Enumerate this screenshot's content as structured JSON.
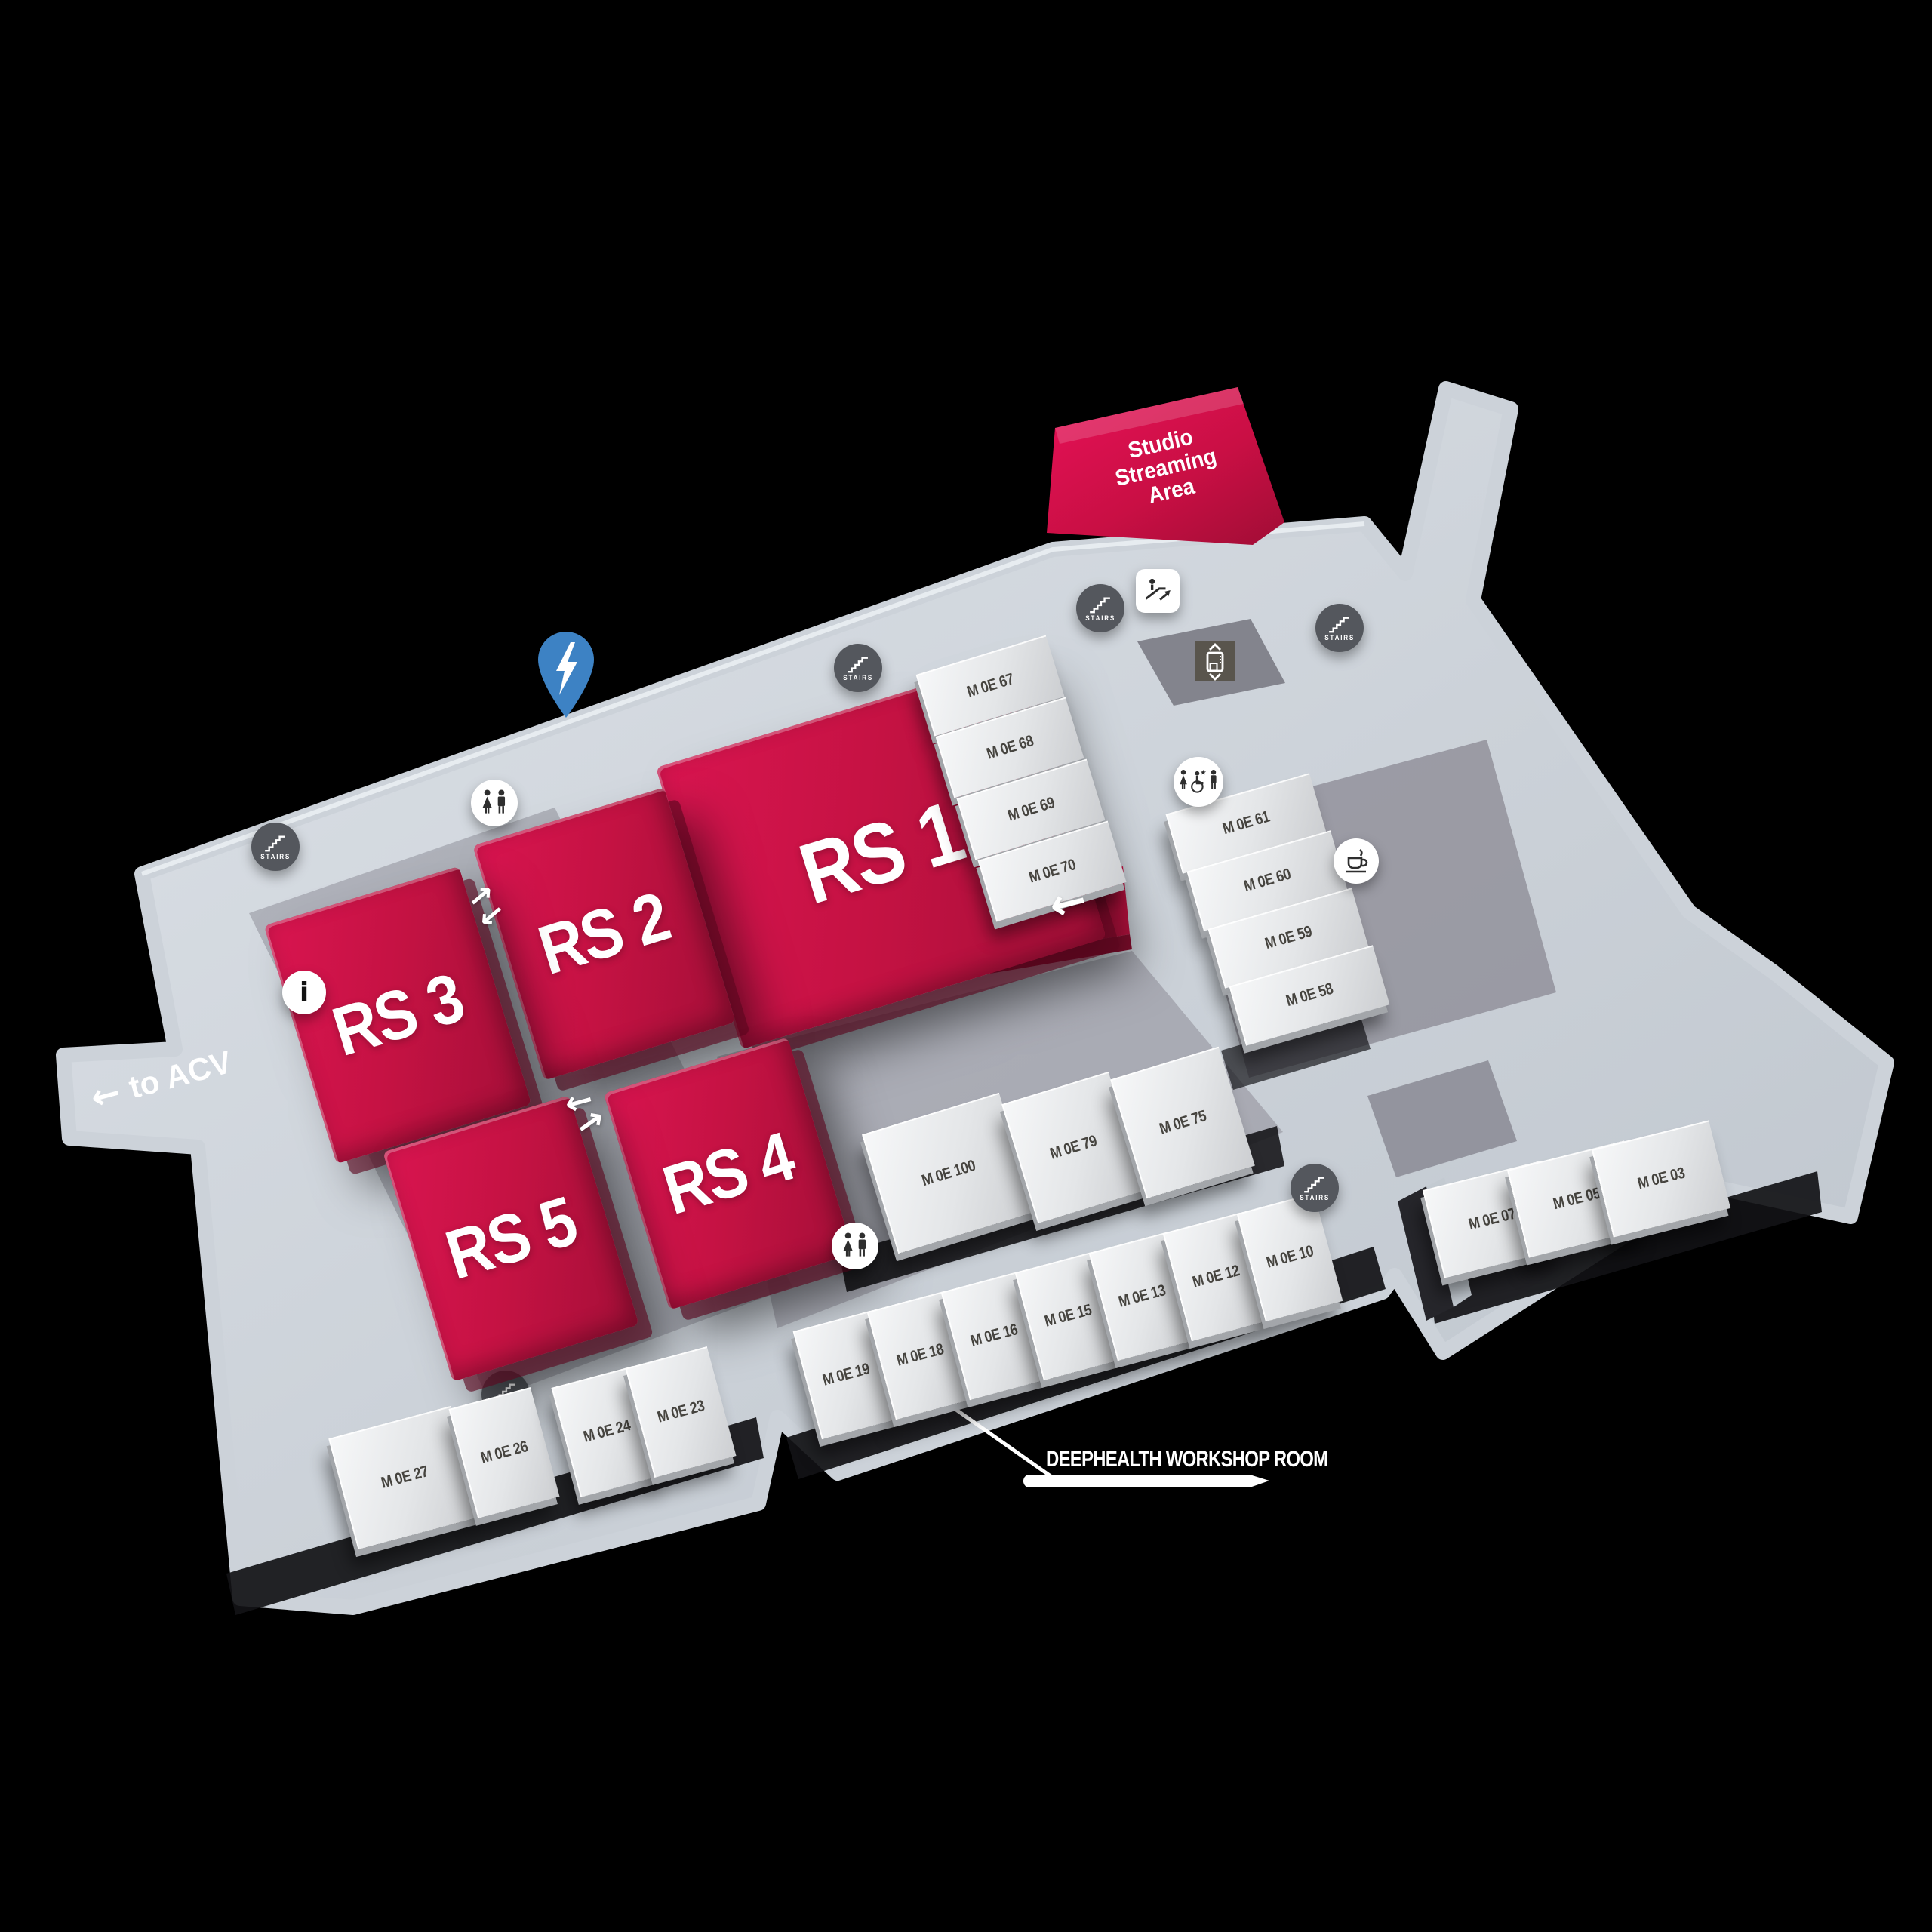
{
  "palette": {
    "background": "#000000",
    "floor": "#c9cfd6",
    "platform_dark": "#8e8d97",
    "red": "#c51243",
    "red_bright": "#e01155",
    "block_face": "#eceef0",
    "room_label": "#46443f",
    "stairs_circle": "#54575d",
    "pin_blue": "#3d82c4",
    "white": "#ffffff"
  },
  "labels": {
    "stairs": "STAIRS",
    "to_acv": "to ACV",
    "arrow_left": "←",
    "arrow_right": "→",
    "deephealth": "DEEPHEALTH WORKSHOP ROOM",
    "info_glyph": "i"
  },
  "studio": {
    "line1": "Studio",
    "line2": "Streaming",
    "line3": "Area"
  },
  "rs_blocks": [
    {
      "label": "RS 1"
    },
    {
      "label": "RS 2"
    },
    {
      "label": "RS 3"
    },
    {
      "label": "RS 4"
    },
    {
      "label": "RS 5"
    }
  ],
  "rooms": {
    "east_of_rs1": [
      "M 0E 67",
      "M 0E 68",
      "M 0E 69",
      "M 0E 70"
    ],
    "northeast_cluster": [
      "M 0E 61",
      "M 0E 60",
      "M 0E 59",
      "M 0E 58"
    ],
    "center_row": [
      "M 0E 100",
      "M 0E 79",
      "M 0E 75"
    ],
    "east_row": [
      "M 0E 07",
      "M 0E 05",
      "M 0E 03"
    ],
    "south_row": [
      "M 0E 19",
      "M 0E 18",
      "M 0E 16",
      "M 0E 15",
      "M 0E 13",
      "M 0E 12",
      "M 0E 10"
    ],
    "southwest_row": [
      "M 0E 27",
      "M 0E 26",
      "M 0E 24",
      "M 0E 23"
    ]
  },
  "icons": {
    "stairs": "stairs-icon",
    "toilets": "toilets-icon",
    "accessible_toilets": "accessible-toilets-icon",
    "coffee": "coffee-icon",
    "info": "info-icon",
    "escalator": "escalator-icon",
    "elevator": "elevator-icon",
    "lightning_pin": "lightning-pin-icon"
  }
}
